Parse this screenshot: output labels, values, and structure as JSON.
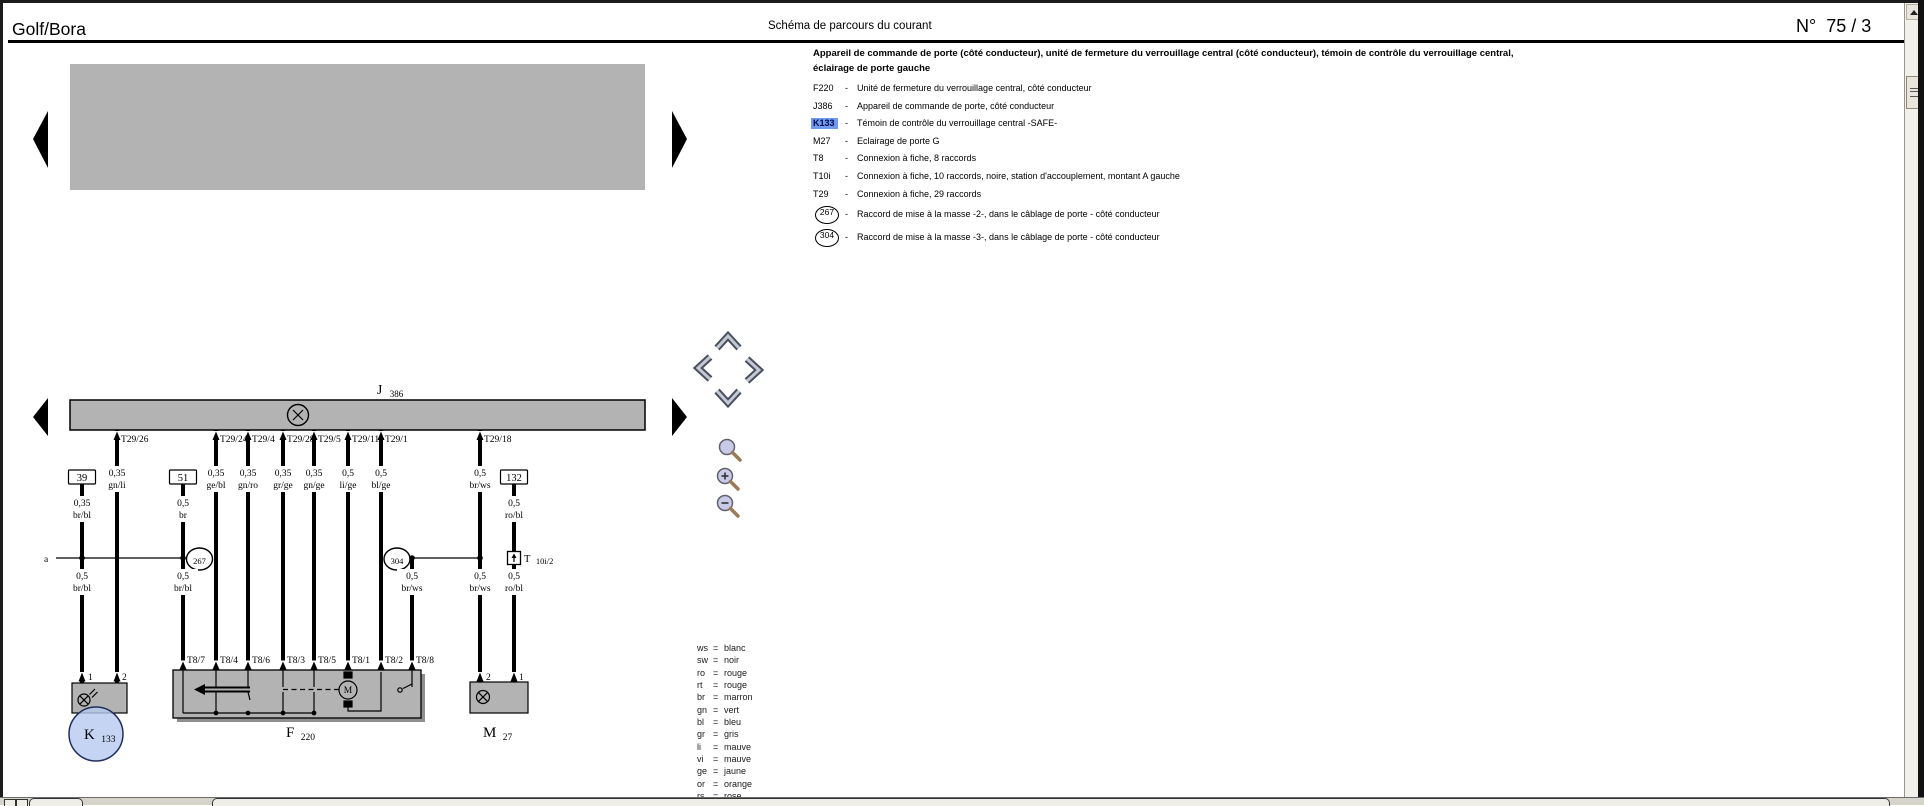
{
  "header": {
    "model": "Golf/Bora",
    "title": "Schéma de parcours du courant",
    "page_label": "N°",
    "page_number": "75 / 3"
  },
  "legend": {
    "title_line1": "Appareil de commande de porte (côté conducteur), unité de fermeture du verrouillage central (côté conducteur), témoin de contrôle du verrouillage central,",
    "title_line2": "éclairage de porte gauche",
    "dash": "-",
    "highlight_color": "#6f9af0",
    "items": [
      {
        "code": "F220",
        "desc": "Unité de fermeture du verrouillage central, côté conducteur"
      },
      {
        "code": "J386",
        "desc": "Appareil de commande de porte, côté conducteur"
      },
      {
        "code": "K133",
        "desc": "Témoin de contrôle du verrouillage central -SAFE-"
      },
      {
        "code": "M27",
        "desc": "Eclairage de porte G"
      },
      {
        "code": "T8",
        "desc": "Connexion à fiche, 8 raccords"
      },
      {
        "code": "T10i",
        "desc": "Connexion à fiche, 10 raccords, noire, station d'accouplement, montant A gauche"
      },
      {
        "code": "T29",
        "desc": "Connexion à fiche, 29 raccords"
      },
      {
        "code": "267",
        "desc": "Raccord de mise à la masse -2-, dans le câblage de porte - côté conducteur"
      },
      {
        "code": "304",
        "desc": "Raccord de mise à la masse -3-, dans le câblage de porte - côté conducteur"
      }
    ]
  },
  "color_legend": [
    {
      "abbr": "ws",
      "eq": "=",
      "name": "blanc"
    },
    {
      "abbr": "sw",
      "eq": "=",
      "name": "noir"
    },
    {
      "abbr": "ro",
      "eq": "=",
      "name": "rouge"
    },
    {
      "abbr": "rt",
      "eq": "=",
      "name": "rouge"
    },
    {
      "abbr": "br",
      "eq": "=",
      "name": "marron"
    },
    {
      "abbr": "gn",
      "eq": "=",
      "name": "vert"
    },
    {
      "abbr": "bl",
      "eq": "=",
      "name": "bleu"
    },
    {
      "abbr": "gr",
      "eq": "=",
      "name": "gris"
    },
    {
      "abbr": "li",
      "eq": "=",
      "name": "mauve"
    },
    {
      "abbr": "vi",
      "eq": "=",
      "name": "mauve"
    },
    {
      "abbr": "ge",
      "eq": "=",
      "name": "jaune"
    },
    {
      "abbr": "or",
      "eq": "=",
      "name": "orange"
    },
    {
      "abbr": "rs",
      "eq": "=",
      "name": "rose"
    }
  ],
  "diagram": {
    "j386": {
      "letter": "J",
      "sub": "386"
    },
    "bar_pins": [
      "T29/26",
      "T29/24",
      "T29/4",
      "T29/28",
      "T29/5",
      "T29/11",
      "T29/1",
      "T29/18"
    ],
    "ref_boxes": [
      "39",
      "51",
      "132"
    ],
    "row_top": [
      {
        "gauge": "0,35",
        "color": "gn/li"
      },
      {
        "gauge": "0,35",
        "color": "ge/bl"
      },
      {
        "gauge": "0,35",
        "color": "gn/ro"
      },
      {
        "gauge": "0,35",
        "color": "gr/ge"
      },
      {
        "gauge": "0,35",
        "color": "gn/ge"
      },
      {
        "gauge": "0,5",
        "color": "li/ge"
      },
      {
        "gauge": "0,5",
        "color": "bl/ge"
      },
      {
        "gauge": "0,5",
        "color": "br/ws"
      }
    ],
    "row_ref": [
      {
        "gauge": "0,35",
        "color": "br/bl"
      },
      {
        "gauge": "0,5",
        "color": "br"
      },
      {
        "gauge": "0,5",
        "color": "ro/bl"
      }
    ],
    "row_ground": [
      {
        "gauge": "0,5",
        "color": "br/bl"
      },
      {
        "gauge": "0,5",
        "color": "br/bl"
      },
      {
        "gauge": "0,5",
        "color": "br/ws"
      },
      {
        "gauge": "0,5",
        "color": "br/ws"
      },
      {
        "gauge": "0,5",
        "color": "ro/bl"
      }
    ],
    "track_label": "a",
    "ground_points": {
      "g267": "267",
      "g304": "304"
    },
    "t10i": {
      "letter": "T",
      "sub": "10i/2"
    },
    "f220_pins": [
      "T8/7",
      "T8/4",
      "T8/6",
      "T8/3",
      "T8/5",
      "T8/1",
      "T8/2",
      "T8/8"
    ],
    "k133_pins": [
      "1",
      "2"
    ],
    "m27_pins": [
      "2",
      "1"
    ],
    "components": {
      "k133": {
        "letter": "K",
        "sub": "133"
      },
      "f220": {
        "letter": "F",
        "sub": "220"
      },
      "m27": {
        "letter": "M",
        "sub": "27"
      },
      "motor": "M"
    }
  }
}
